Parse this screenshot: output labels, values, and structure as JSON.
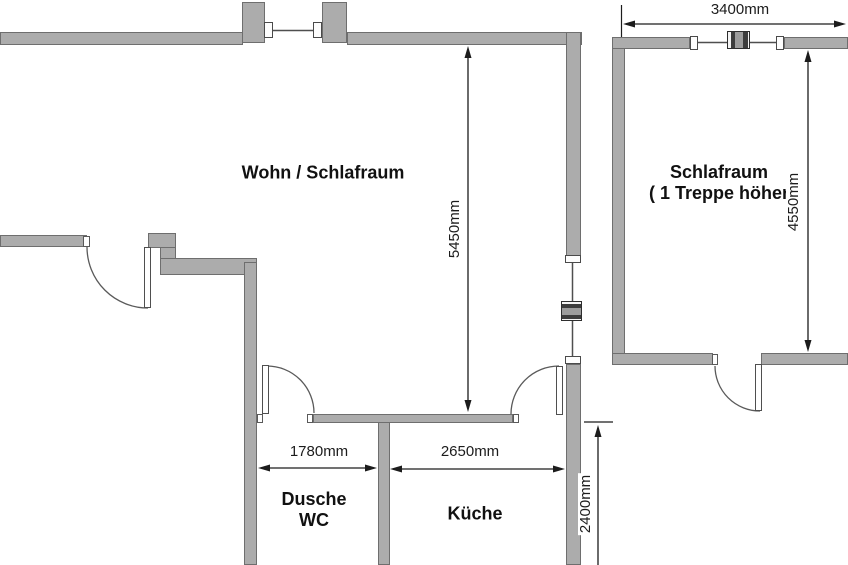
{
  "floorplan": {
    "rooms": {
      "wohn": {
        "label": "Wohn / Schlafraum"
      },
      "schlafraum": {
        "label": "Schlafraum",
        "label2": "( 1 Treppe höher"
      },
      "dusche": {
        "label": "Dusche",
        "label2": "WC"
      },
      "kueche": {
        "label": "Küche"
      }
    },
    "dimensions": {
      "wohnraum_depth": "5450mm",
      "schlafraum_width": "3400mm",
      "schlafraum_depth": "4550mm",
      "dusche_width": "1780mm",
      "kueche_width": "2650mm",
      "kueche_depth": "2400mm"
    },
    "colors": {
      "wall_fill": "#acacac",
      "wall_outline": "#6e6e6e",
      "dimension_line": "#1c1c1c",
      "text": "#111111",
      "background": "#ffffff"
    }
  }
}
